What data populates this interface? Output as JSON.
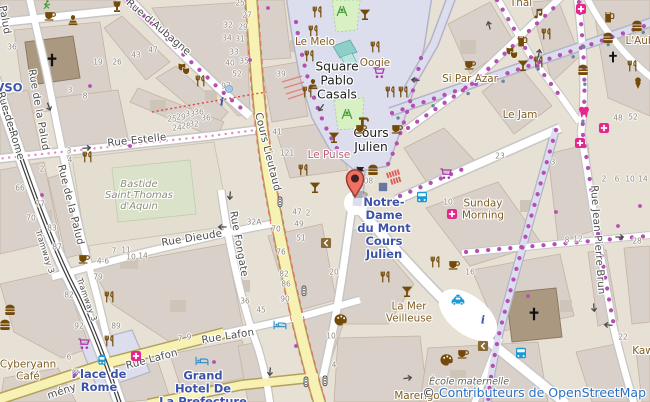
{
  "map": {
    "width": 650,
    "height": 402,
    "marker": {
      "x": 355,
      "y": 197,
      "color": "#ef7161"
    }
  },
  "attribution": {
    "copyright": "©",
    "link_text": "Contributeurs de OpenStreetMap"
  },
  "colors": {
    "road_secondary_fill": "#f7f2b4",
    "pedestrian_fill": "#dcdeed",
    "building": "#d9d0c9",
    "church": "#ab9880",
    "poi_brown": "#734a08",
    "shop_purple": "#ac39ac",
    "health_pink": "#e6268e",
    "transport_blue": "#1a9ad6",
    "transit_label": "#3e53a8",
    "nightclub_label": "#bf5b77",
    "street_label": "#4d4d4d",
    "marker_red": "#ef7161"
  },
  "street_labels": [
    [
      "Rue d'Aubagne",
      158,
      28,
      40
    ],
    [
      "Rue Estelle",
      137,
      141,
      -6
    ],
    [
      "Palud",
      4,
      20,
      80
    ],
    [
      "Rue de la Palud",
      38,
      110,
      80
    ],
    [
      "Rue de la Palud",
      70,
      205,
      76
    ],
    [
      "Rue de Rome",
      10,
      126,
      73
    ],
    [
      "Tramway 3",
      44,
      252,
      72,
      8
    ],
    [
      "Tramway 3",
      86,
      300,
      70,
      8
    ],
    [
      "Cours Lieutaud",
      267,
      152,
      76
    ],
    [
      "Rue Dieude",
      192,
      239,
      -9
    ],
    [
      "Rue Fongate",
      238,
      244,
      80
    ],
    [
      "Rue Lafon",
      152,
      360,
      -15
    ],
    [
      "Rue Lafon",
      228,
      337,
      -9
    ],
    [
      "mény",
      62,
      392,
      -19
    ],
    [
      "Rue Jean Pierre Brun",
      597,
      240,
      86
    ]
  ],
  "place_labels": [
    {
      "lines": [
        "Square",
        "Pablo",
        "Casals"
      ],
      "x": 337,
      "y": 81
    },
    {
      "lines": [
        "Cours",
        "Julien"
      ],
      "x": 371,
      "y": 141
    }
  ],
  "transit_labels": [
    {
      "lines": [
        "Notre-",
        "Dame",
        "du Mont",
        "Cours",
        "Julien"
      ],
      "x": 384,
      "y": 228
    },
    {
      "lines": [
        "Place de",
        "Rome"
      ],
      "x": 99,
      "y": 381
    },
    {
      "lines": [
        "Grand",
        "Hotel De",
        "La Prefecture"
      ],
      "x": 203,
      "y": 389
    },
    {
      "lines": [
        "VSO"
      ],
      "x": 9,
      "y": 88
    }
  ],
  "poi_labels": [
    {
      "lines": [
        "Le Melo"
      ],
      "x": 315,
      "y": 43
    },
    {
      "lines": [
        "Oogie"
      ],
      "x": 375,
      "y": 64
    },
    {
      "lines": [
        "Si Par Azar"
      ],
      "x": 470,
      "y": 80
    },
    {
      "lines": [
        "Le Jam"
      ],
      "x": 520,
      "y": 116
    },
    {
      "lines": [
        "Thai"
      ],
      "x": 521,
      "y": 4
    },
    {
      "lines": [
        "L'Aub"
      ],
      "x": 640,
      "y": 42
    },
    {
      "lines": [
        "Sunday",
        "Morning"
      ],
      "x": 483,
      "y": 210
    },
    {
      "lines": [
        "La Mer",
        "Veilleuse"
      ],
      "x": 409,
      "y": 313
    },
    {
      "lines": [
        "Marengo"
      ],
      "x": 417,
      "y": 397
    },
    {
      "lines": [
        "Cyberyann",
        "Café"
      ],
      "x": 28,
      "y": 371
    },
    {
      "lines": [
        "Kaw"
      ],
      "x": 643,
      "y": 352
    }
  ],
  "nightclub_labels": [
    {
      "lines": [
        "Le Pulse"
      ],
      "x": 329,
      "y": 156
    }
  ],
  "historic_labels": [
    {
      "lines": [
        "Bastide",
        "Saint-Thomas",
        "d'Aquin"
      ],
      "x": 139,
      "y": 196
    }
  ],
  "school_labels": [
    {
      "lines": [
        "École maternelle",
        "des"
      ],
      "x": 469,
      "y": 388
    }
  ],
  "house_numbers": [
    [
      "36",
      12,
      47
    ],
    [
      "19",
      98,
      62
    ],
    [
      "26",
      117,
      62
    ],
    [
      "43",
      136,
      55
    ],
    [
      "47",
      153,
      50
    ],
    [
      "3",
      70,
      90
    ],
    [
      "8",
      85,
      96
    ],
    [
      "25",
      240,
      3
    ],
    [
      "27",
      247,
      15
    ],
    [
      "32",
      228,
      25
    ],
    [
      "29",
      243,
      27
    ],
    [
      "34",
      227,
      38
    ],
    [
      "31",
      240,
      39
    ],
    [
      "33",
      234,
      52
    ],
    [
      "35",
      244,
      61
    ],
    [
      "40",
      230,
      63
    ],
    [
      "52",
      237,
      74
    ],
    [
      "97",
      226,
      86
    ],
    [
      "39",
      281,
      74
    ],
    [
      "36",
      206,
      118
    ],
    [
      "41",
      277,
      132
    ],
    [
      "121",
      287,
      153
    ],
    [
      "25",
      172,
      119
    ],
    [
      "29",
      181,
      117
    ],
    [
      "33",
      190,
      114
    ],
    [
      "36",
      199,
      112
    ],
    [
      "24",
      177,
      128
    ],
    [
      "28",
      186,
      126
    ],
    [
      "32",
      194,
      124
    ],
    [
      "66",
      20,
      188
    ],
    [
      "77",
      40,
      204
    ],
    [
      "70",
      31,
      218
    ],
    [
      "83",
      52,
      228
    ],
    [
      "87",
      57,
      247
    ],
    [
      "2",
      42,
      169
    ],
    [
      "3",
      69,
      151
    ],
    [
      "4",
      70,
      160
    ],
    [
      "7",
      114,
      251
    ],
    [
      "11",
      126,
      250
    ],
    [
      "10",
      131,
      257
    ],
    [
      "14",
      143,
      256
    ],
    [
      "4-6",
      103,
      261
    ],
    [
      "32A",
      254,
      222
    ],
    [
      "47",
      297,
      212
    ],
    [
      "2",
      308,
      213
    ],
    [
      "49",
      299,
      224
    ],
    [
      "51",
      301,
      238
    ],
    [
      "70",
      276,
      229
    ],
    [
      "76",
      281,
      252
    ],
    [
      "82",
      284,
      274
    ],
    [
      "86",
      286,
      284
    ],
    [
      "90",
      285,
      299
    ],
    [
      "36",
      245,
      301
    ],
    [
      "45",
      261,
      310
    ],
    [
      "108",
      366,
      181
    ],
    [
      "20",
      334,
      272
    ],
    [
      "10",
      331,
      336
    ],
    [
      "4",
      334,
      365
    ],
    [
      "79",
      98,
      277
    ],
    [
      "82",
      69,
      295
    ],
    [
      "92",
      79,
      326
    ],
    [
      "89",
      116,
      326
    ],
    [
      "6",
      69,
      357
    ],
    [
      "8",
      76,
      373
    ],
    [
      "7",
      180,
      339
    ],
    [
      "9",
      189,
      337
    ],
    [
      "23",
      500,
      156
    ],
    [
      "3",
      553,
      162
    ],
    [
      "10",
      448,
      202
    ],
    [
      "2",
      604,
      179
    ],
    [
      "6",
      617,
      179
    ],
    [
      "10",
      630,
      179
    ],
    [
      "14",
      643,
      179
    ],
    [
      "8",
      567,
      240
    ],
    [
      "12",
      578,
      239
    ],
    [
      "28",
      637,
      241
    ],
    [
      "48",
      618,
      118
    ],
    [
      "52",
      633,
      117
    ],
    [
      "22",
      623,
      337
    ],
    [
      "16",
      470,
      272
    ]
  ],
  "pois": [
    [
      "cafe",
      50,
      15
    ],
    [
      "statue",
      73,
      21
    ],
    [
      "carafe",
      117,
      7
    ],
    [
      "fitness",
      46,
      5
    ],
    [
      "restaurant",
      318,
      12
    ],
    [
      "restaurant",
      314,
      31
    ],
    [
      "bar",
      365,
      15
    ],
    [
      "restaurant",
      376,
      47
    ],
    [
      "restaurant",
      310,
      56
    ],
    [
      "restaurant",
      308,
      92
    ],
    [
      "shop",
      379,
      73
    ],
    [
      "restaurant",
      391,
      92
    ],
    [
      "restaurant",
      404,
      92
    ],
    [
      "drinking_water",
      364,
      121
    ],
    [
      "cafe",
      397,
      128
    ],
    [
      "cafe",
      361,
      128
    ],
    [
      "theatre",
      184,
      68
    ],
    [
      "restaurant",
      201,
      81
    ],
    [
      "music",
      538,
      14
    ],
    [
      "restaurant",
      547,
      34
    ],
    [
      "pub",
      522,
      41
    ],
    [
      "theatre",
      512,
      52
    ],
    [
      "bar",
      523,
      66
    ],
    [
      "restaurant",
      539,
      62
    ],
    [
      "fastfood",
      637,
      26
    ],
    [
      "fastfood",
      608,
      38
    ],
    [
      "fastfood",
      583,
      70
    ],
    [
      "worship",
      613,
      57
    ],
    [
      "restaurant",
      633,
      66
    ],
    [
      "icecream",
      638,
      83
    ],
    [
      "dentist",
      584,
      112
    ],
    [
      "pharmacy",
      581,
      9
    ],
    [
      "pub",
      609,
      17
    ],
    [
      "cafe",
      470,
      64
    ],
    [
      "pharmacy",
      580,
      143
    ],
    [
      "pharmacy",
      604,
      128
    ],
    [
      "restaurant",
      88,
      157
    ],
    [
      "cafe",
      84,
      258
    ],
    [
      "restaurant",
      304,
      170
    ],
    [
      "bar",
      315,
      188
    ],
    [
      "bar",
      334,
      138
    ],
    [
      "fastfood",
      373,
      170
    ],
    [
      "flag",
      361,
      172
    ],
    [
      "metro",
      383,
      187
    ],
    [
      "stairs",
      395,
      177
    ],
    [
      "bus",
      422,
      197
    ],
    [
      "pharmacy",
      452,
      214
    ],
    [
      "shop",
      446,
      174
    ],
    [
      "taxi",
      458,
      300
    ],
    [
      "info",
      483,
      320
    ],
    [
      "bus",
      521,
      353
    ],
    [
      "door",
      483,
      346
    ],
    [
      "door",
      326,
      243
    ],
    [
      "artwork",
      341,
      320
    ],
    [
      "artwork",
      447,
      360
    ],
    [
      "cafe",
      463,
      353
    ],
    [
      "bar",
      407,
      292
    ],
    [
      "restaurant",
      386,
      277
    ],
    [
      "fastfood",
      10,
      310
    ],
    [
      "fastfood",
      5,
      325
    ],
    [
      "restaurant",
      110,
      297
    ],
    [
      "restaurant",
      110,
      341
    ],
    [
      "shop",
      84,
      344
    ],
    [
      "pharmacy",
      136,
      356
    ],
    [
      "hotel",
      202,
      361
    ],
    [
      "hotel",
      280,
      325
    ],
    [
      "tram",
      102,
      360
    ],
    [
      "signals",
      280,
      202
    ],
    [
      "signals",
      304,
      291
    ],
    [
      "signals",
      306,
      382
    ],
    [
      "signals",
      325,
      381
    ],
    [
      "playground",
      342,
      11
    ],
    [
      "playground",
      347,
      114
    ],
    [
      "statue",
      313,
      85
    ],
    [
      "info",
      222,
      102
    ],
    [
      "restaurant",
      436,
      262
    ],
    [
      "cafe",
      454,
      264
    ],
    [
      "bluedot",
      229,
      89
    ],
    [
      "worship_big",
      52,
      60
    ],
    [
      "worship_big",
      534,
      314
    ],
    [
      "shopdot",
      90,
      86
    ],
    [
      "shopdot",
      130,
      146
    ],
    [
      "shopdot",
      214,
      362
    ],
    [
      "shopdot",
      296,
      346
    ],
    [
      "shopdot",
      528,
      296
    ],
    [
      "shopdot",
      556,
      212
    ],
    [
      "shopdot",
      618,
      226
    ],
    [
      "shopdot",
      640,
      206
    ],
    [
      "shopdot",
      42,
      195
    ],
    [
      "shopdot",
      75,
      375
    ],
    [
      "shopdot",
      268,
      8
    ],
    [
      "shopdot",
      250,
      60
    ]
  ],
  "arrows": [
    [
      87,
      148,
      -5
    ],
    [
      415,
      80,
      185
    ],
    [
      489,
      25,
      -105
    ],
    [
      539,
      53,
      -80
    ],
    [
      620,
      237,
      0
    ],
    [
      594,
      308,
      85
    ],
    [
      608,
      325,
      185
    ],
    [
      408,
      378,
      -8
    ],
    [
      230,
      196,
      95
    ],
    [
      222,
      227,
      180
    ],
    [
      49,
      107,
      70
    ],
    [
      270,
      372,
      95
    ],
    [
      321,
      108,
      125
    ]
  ]
}
